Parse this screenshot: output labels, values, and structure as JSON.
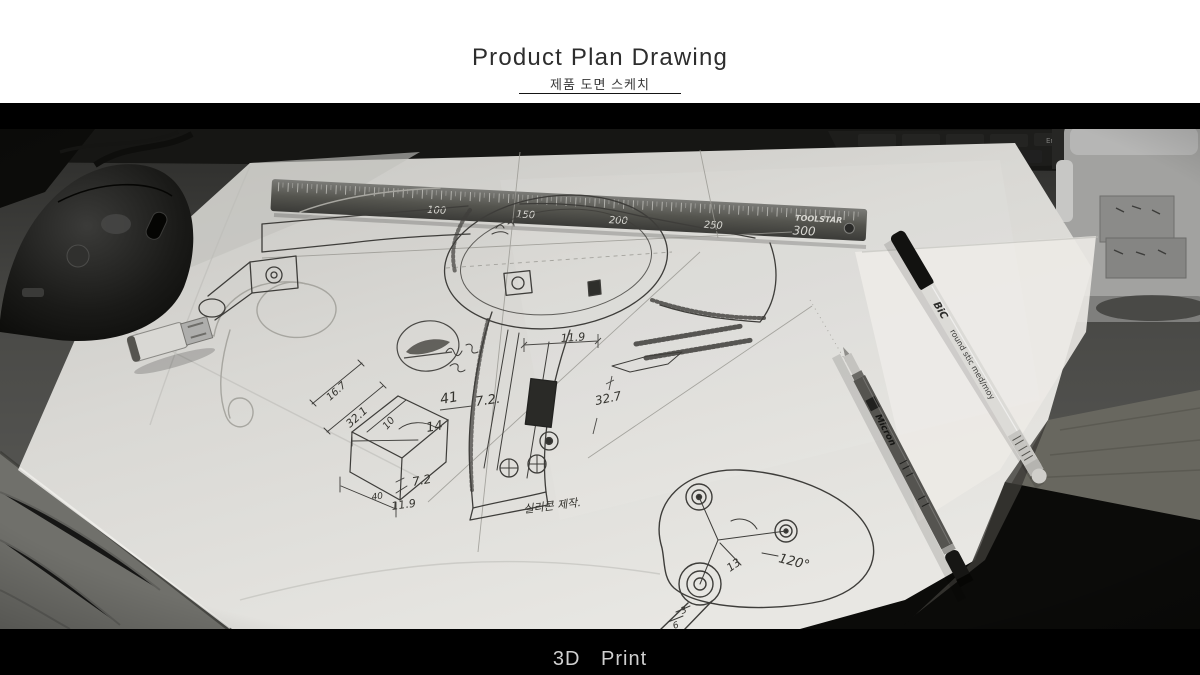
{
  "header": {
    "title": "Product Plan Drawing",
    "subtitle": "제품 도면 스케치"
  },
  "footer": {
    "caption": "3D Print"
  },
  "photo": {
    "ruler": {
      "brand": "TOOLSTAR",
      "numbers": [
        "100",
        "150",
        "200",
        "250"
      ],
      "end_label": "300"
    },
    "pens": {
      "bic_logo": "BiC",
      "bic_text": "round stic  med/moy",
      "fineliner_text": "Micron"
    },
    "keyboard": {
      "key": "End"
    },
    "sketch": {
      "annotations": [
        "11.9",
        "41",
        "7.2.",
        "32.7",
        "14",
        "16.7",
        "32.1",
        "10",
        "7.2",
        "40",
        "11.9",
        "120°",
        "13",
        "3",
        "6"
      ],
      "note": "실리콘 제작."
    }
  },
  "colors": {
    "band_black": "#000000",
    "paper": "#d9d8d4",
    "ink": "#3e3d3a",
    "caption_gray": "#cfcfcf"
  }
}
